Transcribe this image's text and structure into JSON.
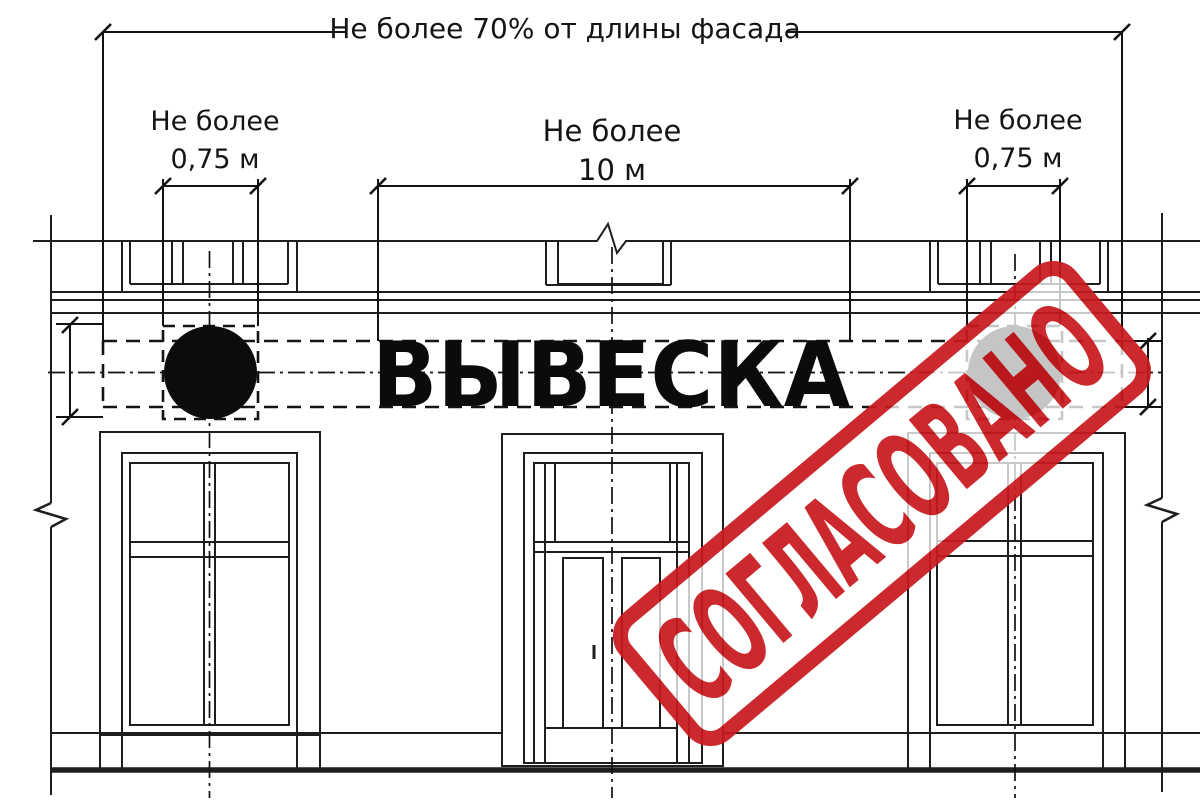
{
  "drawing": {
    "top_dimension_label": "Не более 70% от длины фасада",
    "left_dimension": {
      "line1": "Не более",
      "line2": "0,75 м"
    },
    "center_dimension": {
      "line1": "Не более",
      "line2": "10 м"
    },
    "right_dimension": {
      "line1": "Не более",
      "line2": "0,75 м"
    },
    "sign_text": "ВЫВЕСКА"
  },
  "stamp": {
    "text": "СОГЛАСОВАНО",
    "color": "#c8191e"
  },
  "colors": {
    "background": "#ffffff",
    "line": "#1e1e1e",
    "sign_text": "#0b0b0b",
    "stamp_red": "#c8191e"
  }
}
